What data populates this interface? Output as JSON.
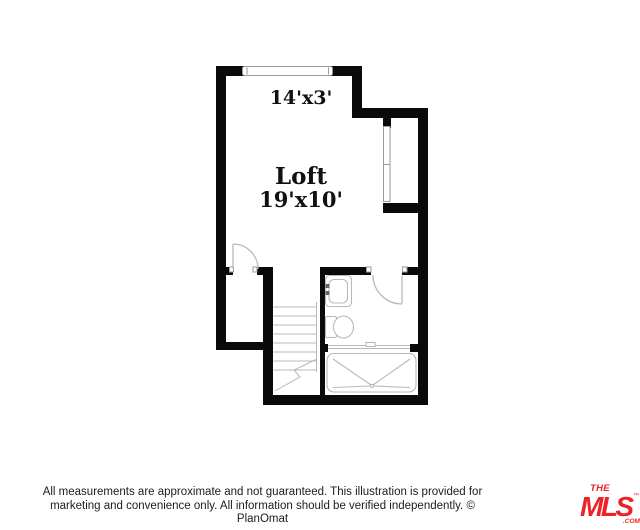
{
  "plan": {
    "upper_area_label": "14'x3'",
    "room": {
      "name": "Loft",
      "dimensions": "19'x10'"
    }
  },
  "footer": {
    "disclaimer_line1": "All measurements are approximate and not guaranteed. This illustration is provided for",
    "disclaimer_line2": "marketing and convenience only. All information should be verified independently. © PlanOmat",
    "text_color": "#1c1c1c"
  },
  "logo": {
    "the": "THE",
    "mls": "MLS",
    "tm": "™",
    "com": ".COM",
    "color": "#ec2227"
  },
  "colors": {
    "wall": "#0a0a0a",
    "fixture_line": "#b8b8b8",
    "window_line": "#9a9a9a",
    "background": "#ffffff"
  }
}
